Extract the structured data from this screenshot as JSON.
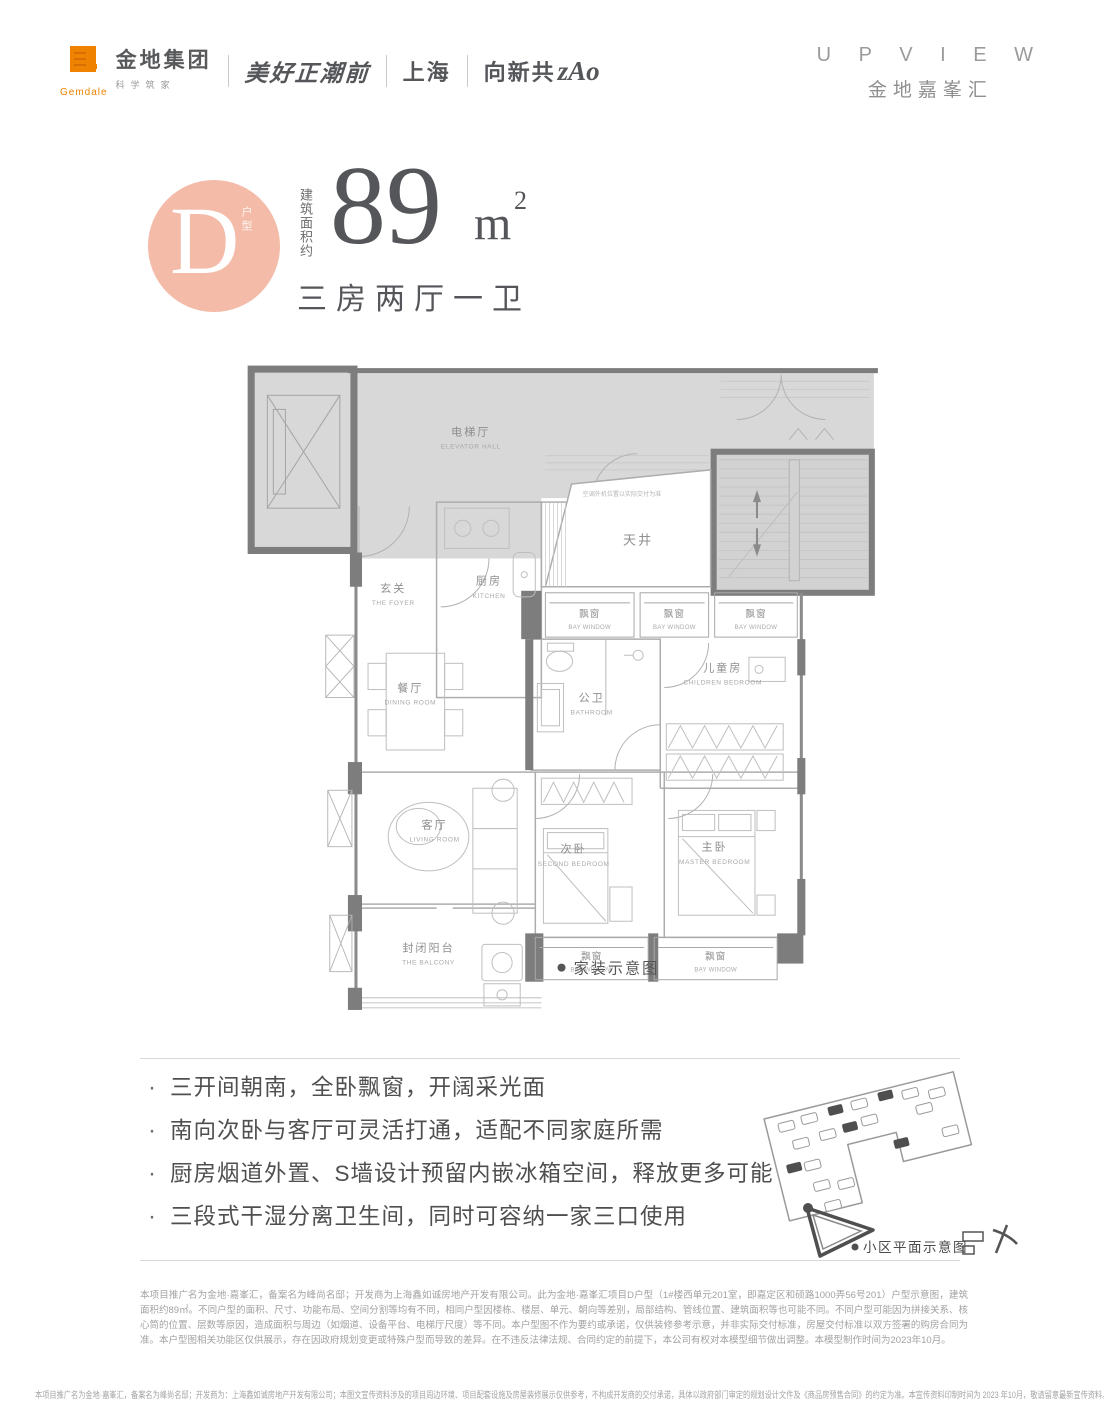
{
  "header": {
    "gemdale": {
      "name_cn": "金地集团",
      "name_en": "Gemdale",
      "tagline": "科学筑家"
    },
    "slogan_campaign": "美好正潮前",
    "city": "上海",
    "slogan_zao_prefix": "向新共",
    "slogan_zao": "zAo",
    "brand_en": "U P V I E W",
    "brand_cn": "金地嘉峯汇"
  },
  "unit": {
    "type_letter": "D",
    "type_label": "户型",
    "area_label": "建筑面积约",
    "area_value": "89",
    "area_unit": "m",
    "area_exp": "2",
    "layout_desc": "三房两厅一卫"
  },
  "floorplan": {
    "rooms": {
      "elevator_hall": {
        "cn": "电梯厅",
        "en": "ELEVATOR HALL"
      },
      "foyer": {
        "cn": "玄关",
        "en": "THE FOYER"
      },
      "kitchen": {
        "cn": "厨房",
        "en": "KITCHEN"
      },
      "lightwell": {
        "cn": "天井",
        "en": ""
      },
      "dining": {
        "cn": "餐厅",
        "en": "DINING ROOM"
      },
      "bathroom": {
        "cn": "公卫",
        "en": "BATHROOM"
      },
      "children": {
        "cn": "儿童房",
        "en": "CHILDREN BEDROOM"
      },
      "living": {
        "cn": "客厅",
        "en": "LIVING ROOM"
      },
      "second_bedroom": {
        "cn": "次卧",
        "en": "SECOND BEDROOM"
      },
      "master_bedroom": {
        "cn": "主卧",
        "en": "MASTER BEDROOM"
      },
      "balcony": {
        "cn": "封闭阳台",
        "en": "THE  BALCONY"
      }
    },
    "bay_window": {
      "cn": "飘窗",
      "en": "BAY WINDOW"
    },
    "ac_note": "空调外机位置以实际交付为准",
    "caption": "家装示意图"
  },
  "features": {
    "bullet": "·",
    "items": [
      "三开间朝南，全卧飘窗，开阔采光面",
      "南向次卧与客厅可灵活打通，适配不同家庭所需",
      "厨房烟道外置、S墙设计预留内嵌冰箱空间，释放更多可能",
      "三段式干湿分离卫生间，同时可容纳一家三口使用"
    ]
  },
  "siteplan": {
    "caption": "小区平面示意图"
  },
  "legal": {
    "disclaimer": "本项目推广名为金地·嘉峯汇，备案名为峰尚名邸；开发商为上海鑫如诚房地产开发有限公司。此为金地·嘉峯汇项目D户型（1#楼西单元201室，即嘉定区和硕路1000弄56号201）户型示意图，建筑面积约89㎡。不同户型的面积、尺寸、功能布局、空间分割等均有不同，相同户型因楼栋、楼层、单元、朝向等差别，局部结构、管线位置、建筑面积等也可能不同。不同户型可能因为拼接关系、核心筒的位置、层数等原因，造成面积与周边（如烟道、设备平台、电梯厅尺度）等不同。本户型图不作为要约或承诺，仅供装修参考示意，并非实际交付标准，房屋交付标准以双方签署的购房合同为准。本户型图相关功能区仅供展示，存在因政府规划变更或特殊户型而导致的差异。在不违反法律法规、合同约定的前提下，本公司有权对本模型细节做出调整。本模型制作时间为2023年10月。",
    "footer": "本项目推广名为金地·嘉峯汇，备案名为峰尚名邸；开发商为：上海鑫如诚房地产开发有限公司；本图文宣传资料涉及的项目周边环境、项目配套设施及房屋装修展示仅供参考，不构成开发商的交付承诺，具体以政府部门审定的规划设计文件及《商品房预售合同》的约定为准。本宣传资料印制时间为 2023 年10月，敬请留意最新宣传资料。"
  }
}
